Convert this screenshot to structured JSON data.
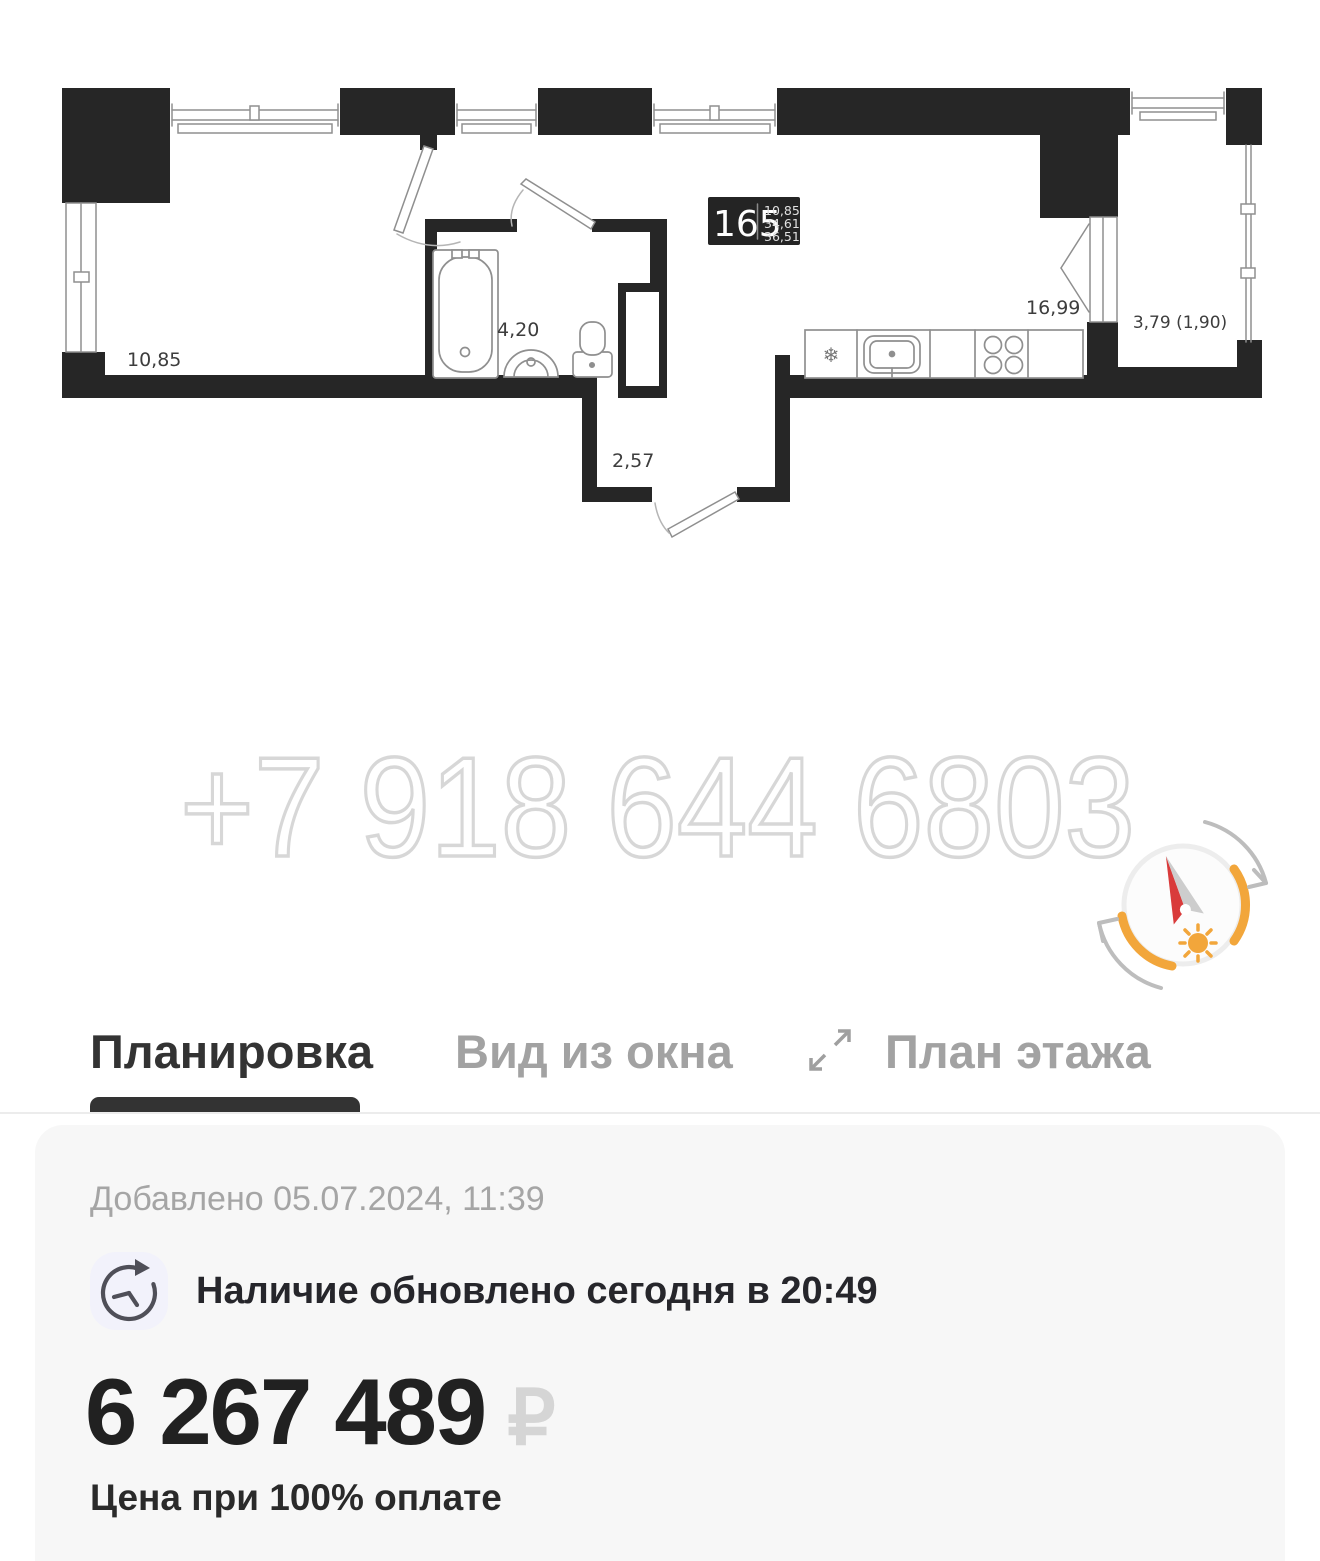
{
  "plan": {
    "unit": {
      "number": "165",
      "area_room": "10,85",
      "area_living": "34,61",
      "area_total": "36,51"
    },
    "labels": {
      "room": "10,85",
      "bathroom": "4,20",
      "hall": "2,57",
      "kitchen": "16,99",
      "balcony": "3,79 (1,90)"
    },
    "fridge_symbol": "❄",
    "watermark": "+7 918 644 6803",
    "colors": {
      "wall": "#262626",
      "compass_orange": "#f2a63b",
      "needle_red": "#d93b3b"
    }
  },
  "tabs": {
    "layout": "Планировка",
    "window_view": "Вид из окна",
    "floor_plan": "План этажа"
  },
  "icons": {
    "expand": "expand-arrows-icon",
    "clock": "history-clock-icon",
    "compass": "sun-compass-icon"
  },
  "card": {
    "added": "Добавлено 05.07.2024, 11:39",
    "availability": "Наличие обновлено сегодня в 20:49",
    "price": "6 267 489",
    "currency": "₽",
    "price_note": "Цена при 100% оплате"
  }
}
